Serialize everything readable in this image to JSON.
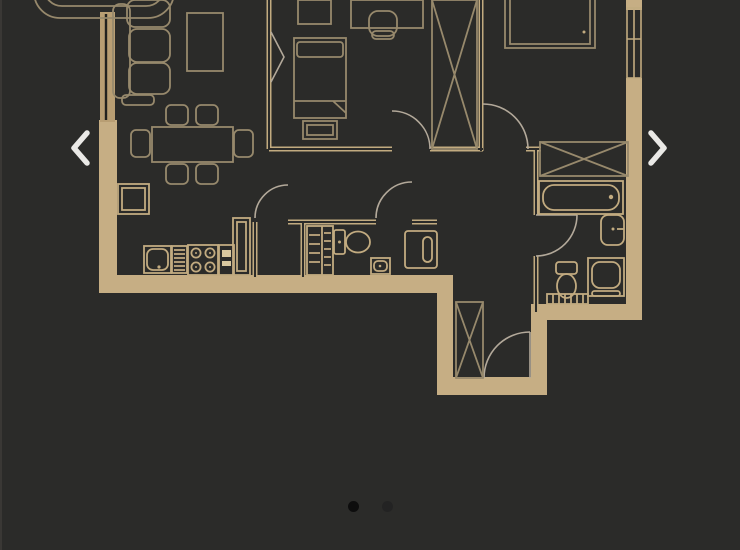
{
  "carousel": {
    "prev_icon": "chevron-left",
    "next_icon": "chevron-right",
    "dots": {
      "count": 2,
      "active_index": 0
    }
  },
  "colors": {
    "background": "#2b2b29",
    "wall": "#c6ae84",
    "line_bright": "#c2ab80",
    "line_dim": "#97896c",
    "line_pale": "#b3a99a",
    "window_fill": "#b89e73",
    "chevron": "#eae9e6",
    "dot_active": "#0d0d0d",
    "dot_inactive": "#232323",
    "edge_strip": "#413f3b"
  },
  "floor_plan": {
    "type": "2-bedroom-apartment-floor-plan",
    "rooms": [
      {
        "name": "balcony",
        "furniture": []
      },
      {
        "name": "living-room",
        "furniture": [
          "sofa",
          "coffee-table",
          "dining-table",
          "six-chairs"
        ]
      },
      {
        "name": "kitchen",
        "furniture": [
          "tall-cabinet",
          "sink",
          "dish-rack",
          "stove-4-burners",
          "oven-unit",
          "corner-counter"
        ]
      },
      {
        "name": "bedroom-1",
        "furniture": [
          "bed",
          "pillow",
          "bench",
          "desk",
          "desk-chair",
          "wardrobe-x",
          "headboard-shelf"
        ]
      },
      {
        "name": "bedroom-2",
        "furniture": [
          "bed",
          "closet-x"
        ]
      },
      {
        "name": "bathroom",
        "furniture": [
          "bathtub",
          "washbasin",
          "toilet",
          "shower-cabinet",
          "radiator"
        ]
      },
      {
        "name": "wc-laundry",
        "furniture": [
          "shelving",
          "toilet",
          "small-washbasin",
          "washing-machine"
        ]
      },
      {
        "name": "entry-hall",
        "furniture": [
          "wardrobe-x",
          "entrance-door"
        ]
      }
    ]
  }
}
